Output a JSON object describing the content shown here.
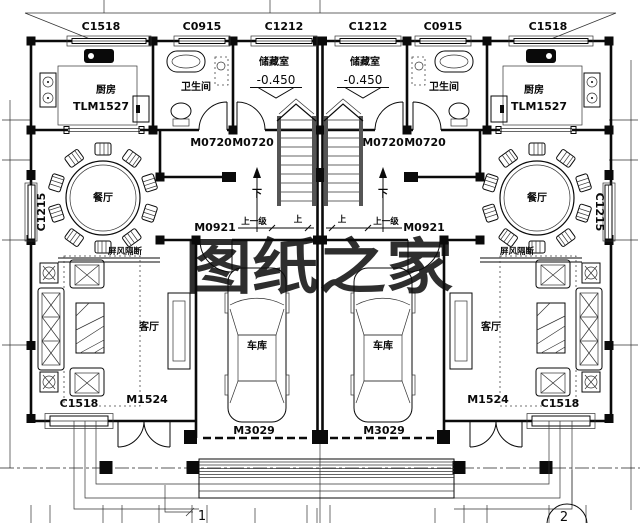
{
  "watermark": {
    "text": "图纸之家",
    "color": "#dc3a3a"
  },
  "codes": {
    "top_windows": [
      "C1518",
      "C0915",
      "C1212",
      "C1212",
      "C0915",
      "C1518"
    ],
    "side_window": "C1215",
    "bottom_window": "C1518",
    "kitchen_door": "TLM1527",
    "hall_door": "M0720",
    "garage_entry_door": "M0921",
    "entry_door": "M1524",
    "garage_door": "M3029"
  },
  "rooms": {
    "kitchen": "厨房",
    "bathroom": "卫生间",
    "storage": "储藏室",
    "dining": "餐厅",
    "living": "客厅",
    "garage": "车库"
  },
  "annotations": {
    "level": "-0.450",
    "down": "下",
    "up": "上",
    "up_one_step": "上一级",
    "screen_partition": "屏风隔断"
  },
  "axis_bubbles": {
    "left": "1",
    "right": "2"
  }
}
